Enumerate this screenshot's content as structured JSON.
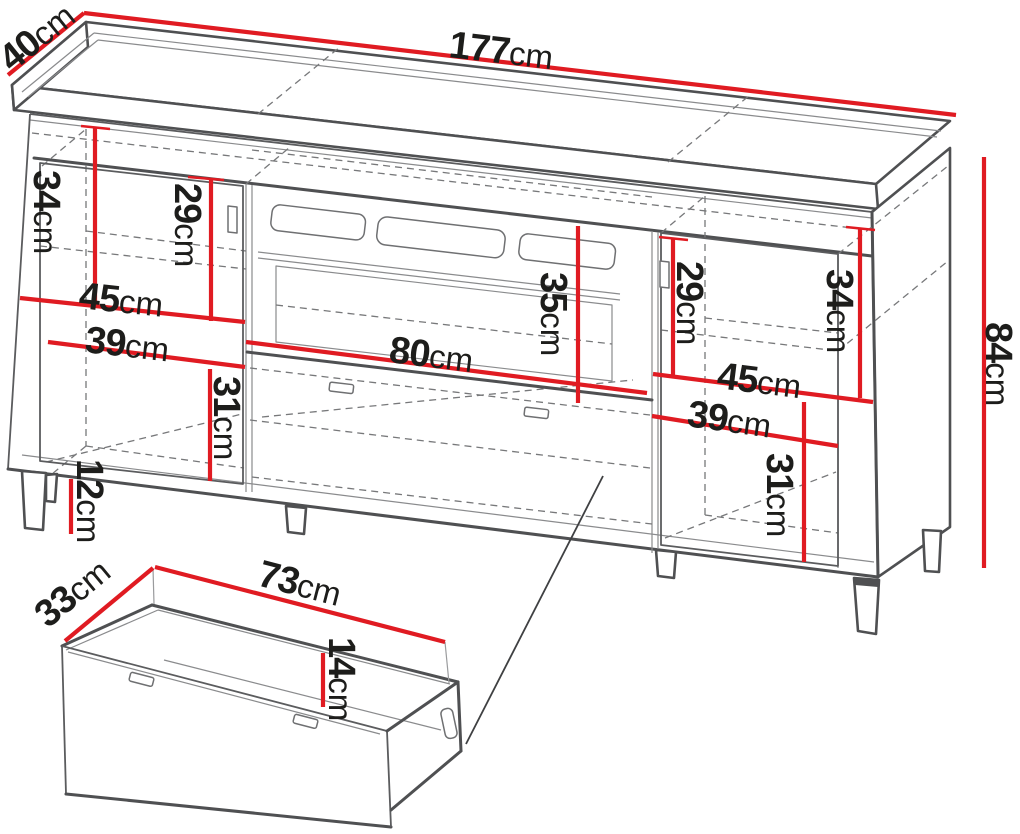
{
  "diagram_type": "furniture-dimension-drawing",
  "unit": "cm",
  "colors": {
    "dimension_line": "#e01b22",
    "outline": "#4f5052",
    "label_text": "#1d1d1b",
    "background": "#ffffff"
  },
  "main_view": {
    "description": "tv-stand-cabinet-isometric",
    "dimensions": {
      "width": {
        "value": "177",
        "unit": "cm"
      },
      "depth": {
        "value": "40",
        "unit": "cm"
      },
      "height": {
        "value": "84",
        "unit": "cm"
      },
      "left_top_section_height": {
        "value": "34",
        "unit": "cm"
      },
      "left_door_upper_height": {
        "value": "29",
        "unit": "cm"
      },
      "left_compartment_width_upper": {
        "value": "45",
        "unit": "cm"
      },
      "left_compartment_width_lower": {
        "value": "39",
        "unit": "cm"
      },
      "left_bottom_section_height": {
        "value": "31",
        "unit": "cm"
      },
      "leg_height": {
        "value": "12",
        "unit": "cm"
      },
      "niche_height": {
        "value": "35",
        "unit": "cm"
      },
      "niche_width": {
        "value": "80",
        "unit": "cm"
      },
      "right_door_upper_height": {
        "value": "29",
        "unit": "cm"
      },
      "right_top_section_height": {
        "value": "34",
        "unit": "cm"
      },
      "right_compartment_width_upper": {
        "value": "45",
        "unit": "cm"
      },
      "right_compartment_width_lower": {
        "value": "39",
        "unit": "cm"
      },
      "right_bottom_section_height": {
        "value": "31",
        "unit": "cm"
      }
    }
  },
  "drawer_detail": {
    "description": "drawer-box-isometric",
    "dimensions": {
      "depth": {
        "value": "33",
        "unit": "cm"
      },
      "width": {
        "value": "73",
        "unit": "cm"
      },
      "height": {
        "value": "14",
        "unit": "cm"
      }
    }
  }
}
